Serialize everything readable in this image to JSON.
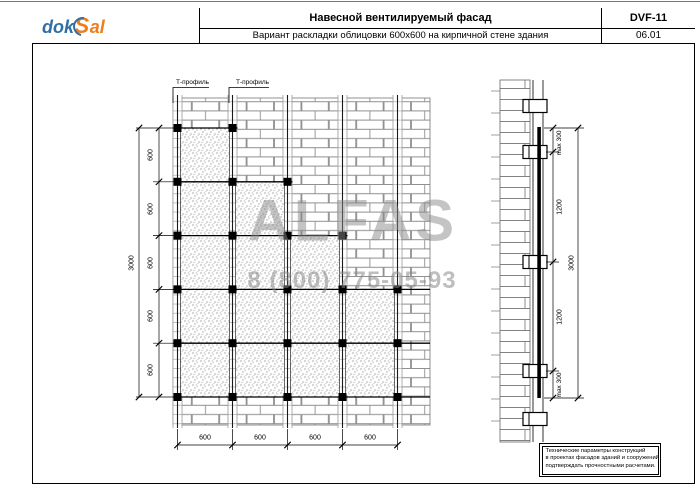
{
  "header": {
    "logo": {
      "prefix": "dok",
      "s": "S",
      "suffix": "al"
    },
    "title": "Навесной вентилируемый фасад",
    "subtitle": "Вариант раскладки облицовки 600х600 на кирпичной стене здания",
    "doc_code": "DVF-11",
    "sheet_no": "06.01"
  },
  "watermark": {
    "brand": "ALFAS",
    "phone": "8 (800) 775-05-93"
  },
  "elevation": {
    "tprofile_labels": [
      "Т-профиль",
      "Т-профиль"
    ],
    "left_dims": [
      "600",
      "600",
      "600",
      "600",
      "600"
    ],
    "left_total": "3000",
    "bottom_dims": [
      "600",
      "600",
      "600",
      "600"
    ]
  },
  "section": {
    "dims": [
      "max 300",
      "1200",
      "1200",
      "max 300"
    ],
    "total": "3000"
  },
  "note": {
    "line1": "Технические параметры конструкций",
    "line2": "в проектах фасадов зданий и сооружений",
    "line3": "подтверждать прочностными расчетами."
  },
  "colors": {
    "logo_blue": "#2f6fa5",
    "logo_orange": "#ef7d1a",
    "watermark_gray": "#8a8a8a"
  }
}
